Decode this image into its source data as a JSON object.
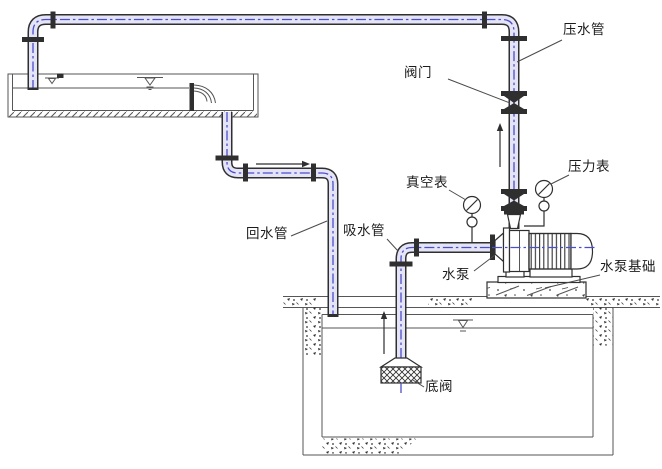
{
  "labels": {
    "pressure_pipe": "压水管",
    "valve": "阀门",
    "vacuum_gauge": "真空表",
    "pressure_gauge": "压力表",
    "return_pipe": "回水管",
    "suction_pipe": "吸水管",
    "pump": "水泵",
    "pump_foundation": "水泵基础",
    "foot_valve": "底阀"
  },
  "colors": {
    "line": "#2f2f2f",
    "thin-line": "#565656",
    "pipe-fill": "#e4e4f6",
    "centerline": "#4a4ecb",
    "label-text": "#1c1c1c",
    "background": "#ffffff"
  }
}
